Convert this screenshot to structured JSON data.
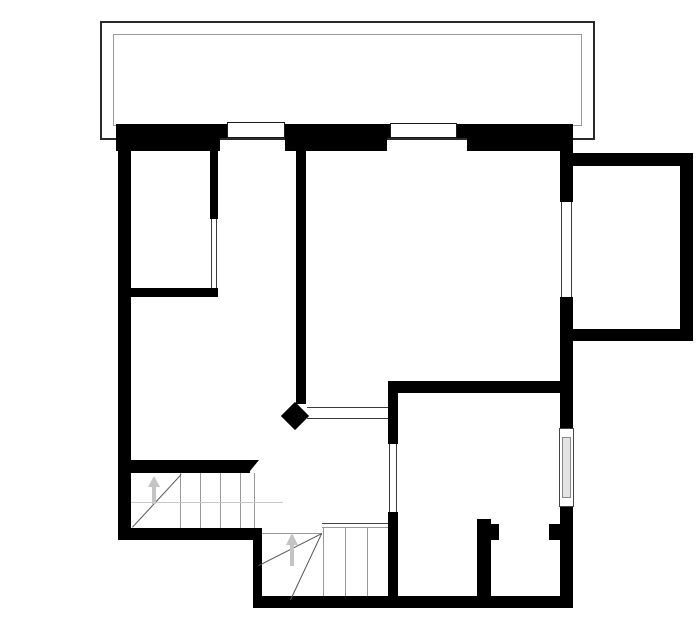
{
  "plan": {
    "canvas": {
      "w": 700,
      "h": 644,
      "bg": "#ffffff"
    },
    "palette": {
      "wall": "#000000",
      "terrace_outer_border": "#2a2a2a",
      "terrace_inner_border": "#9a9a9a",
      "window_border": "#1a1a1a",
      "door_line": "#3a3a3a",
      "stair_dark": "#444444",
      "stair_gray": "#999999",
      "stair_light": "#c8c8c8",
      "diag": "#555555",
      "arrow": "#c4c4c4",
      "glazing_fill": "#e3e3e3",
      "glazing_border": "#8a8a8a",
      "white": "#ffffff"
    },
    "terrace": {
      "outer": {
        "name": "terrace-outer-outline",
        "x": 100,
        "y": 21,
        "w": 495,
        "h": 119
      },
      "inner": {
        "name": "terrace-inner-outline",
        "x": 113,
        "y": 34,
        "w": 469,
        "h": 92
      }
    },
    "walls": [
      {
        "name": "top-wall-left-outer",
        "x": 116,
        "y": 124,
        "w": 111,
        "h": 14
      },
      {
        "name": "top-wall-left-inner",
        "x": 116,
        "y": 138,
        "w": 104,
        "h": 13
      },
      {
        "name": "top-wall-mid-outer",
        "x": 285,
        "y": 124,
        "w": 105,
        "h": 14
      },
      {
        "name": "top-wall-mid-inner",
        "x": 285,
        "y": 138,
        "w": 102,
        "h": 13
      },
      {
        "name": "top-wall-right-outer",
        "x": 457,
        "y": 124,
        "w": 116,
        "h": 14
      },
      {
        "name": "top-wall-right-inner",
        "x": 467,
        "y": 138,
        "w": 106,
        "h": 13
      },
      {
        "name": "left-exterior-wall",
        "x": 118,
        "y": 124,
        "w": 13,
        "h": 416
      },
      {
        "name": "right-exterior-wall-upper",
        "x": 560,
        "y": 124,
        "w": 13,
        "h": 78
      },
      {
        "name": "right-exterior-wall-middle",
        "x": 560,
        "y": 297,
        "w": 13,
        "h": 131
      },
      {
        "name": "right-exterior-wall-lower",
        "x": 560,
        "y": 507,
        "w": 13,
        "h": 101
      },
      {
        "name": "extension-top-wall",
        "x": 573,
        "y": 153,
        "w": 120,
        "h": 13
      },
      {
        "name": "extension-right-wall",
        "x": 680,
        "y": 153,
        "w": 13,
        "h": 188
      },
      {
        "name": "extension-bottom-wall",
        "x": 573,
        "y": 329,
        "w": 120,
        "h": 12
      },
      {
        "name": "bedroom-side-wall",
        "x": 210,
        "y": 138,
        "w": 8,
        "h": 81
      },
      {
        "name": "bedroom-bottom-wall",
        "x": 131,
        "y": 288,
        "w": 87,
        "h": 9
      },
      {
        "name": "center-hall-wall",
        "x": 296,
        "y": 138,
        "w": 10,
        "h": 266
      },
      {
        "name": "living-bottom-wall",
        "x": 388,
        "y": 381,
        "w": 172,
        "h": 12
      },
      {
        "name": "room-divider-wall-upper",
        "x": 388,
        "y": 381,
        "w": 10,
        "h": 63
      },
      {
        "name": "room-divider-wall-lower",
        "x": 388,
        "y": 512,
        "w": 10,
        "h": 89
      },
      {
        "name": "closet-wall-vertical",
        "x": 477,
        "y": 519,
        "w": 14,
        "h": 77
      },
      {
        "name": "closet-wall-stub",
        "x": 491,
        "y": 524,
        "w": 8,
        "h": 16
      },
      {
        "name": "closet-door-jamb",
        "x": 549,
        "y": 524,
        "w": 11,
        "h": 16
      },
      {
        "name": "stair-top-wall",
        "x": 128,
        "y": 460,
        "w": 122,
        "h": 13
      },
      {
        "name": "bottom-wall-left",
        "x": 118,
        "y": 528,
        "w": 137,
        "h": 12
      },
      {
        "name": "stair-divider-wall",
        "x": 253,
        "y": 528,
        "w": 9,
        "h": 80
      },
      {
        "name": "bottom-exterior-wall",
        "x": 253,
        "y": 596,
        "w": 320,
        "h": 12
      }
    ],
    "windows": [
      {
        "name": "window-top-1",
        "x": 227,
        "y": 122,
        "w": 58,
        "h": 16
      },
      {
        "name": "window-top-2",
        "x": 390,
        "y": 123,
        "w": 67,
        "h": 15
      }
    ],
    "glazed_window": {
      "name": "window-right",
      "x": 559,
      "y": 428,
      "w": 15,
      "h": 79,
      "inner": {
        "x": 562,
        "y": 437,
        "w": 9,
        "h": 61
      }
    },
    "openings": [
      {
        "name": "bedroom-door-opening",
        "o": "v",
        "a": 211,
        "b": 216,
        "start": 219,
        "len": 69
      },
      {
        "name": "balcony-door-opening",
        "o": "v",
        "a": 561,
        "b": 571,
        "start": 202,
        "len": 95
      },
      {
        "name": "room-door-opening",
        "o": "v",
        "a": 389,
        "b": 396,
        "start": 444,
        "len": 68
      },
      {
        "name": "hall-passage-opening",
        "o": "h",
        "a": 407,
        "b": 418,
        "start": 307,
        "len": 81
      }
    ],
    "caps": {
      "diamond": {
        "name": "wall-end-cap",
        "cx": 295,
        "cy": 416,
        "size": 20
      },
      "bevel": {
        "name": "stair-wall-bevel",
        "x": 250,
        "y": 460,
        "w": 9,
        "h": 11
      }
    },
    "stairs": {
      "lines": [
        {
          "name": "upper-stair-tread",
          "x": 180,
          "y": 473,
          "len": 55,
          "o": "v",
          "c": "stair_gray"
        },
        {
          "name": "upper-stair-tread",
          "x": 200,
          "y": 473,
          "len": 55,
          "o": "v",
          "c": "stair_gray"
        },
        {
          "name": "upper-stair-tread",
          "x": 220,
          "y": 473,
          "len": 55,
          "o": "v",
          "c": "stair_gray"
        },
        {
          "name": "upper-stair-tread",
          "x": 240,
          "y": 473,
          "len": 55,
          "o": "v",
          "c": "stair_gray"
        },
        {
          "name": "upper-stair-tread",
          "x": 254,
          "y": 473,
          "len": 55,
          "o": "v",
          "c": "stair_gray"
        },
        {
          "name": "upper-stair-landing-line",
          "x": 131,
          "y": 502,
          "len": 152,
          "o": "h",
          "c": "stair_light"
        },
        {
          "name": "lower-stair-edge-dark",
          "x": 322,
          "y": 523,
          "len": 66,
          "o": "h",
          "c": "stair_dark"
        },
        {
          "name": "lower-stair-edge-gray",
          "x": 322,
          "y": 527,
          "len": 66,
          "o": "h",
          "c": "stair_gray"
        },
        {
          "name": "lower-stair-left-edge",
          "x": 262,
          "y": 533,
          "len": 60,
          "o": "h",
          "c": "stair_gray"
        },
        {
          "name": "lower-stair-tread",
          "x": 323,
          "y": 527,
          "len": 69,
          "o": "v",
          "c": "stair_gray"
        },
        {
          "name": "lower-stair-tread",
          "x": 345,
          "y": 527,
          "len": 69,
          "o": "v",
          "c": "stair_gray"
        },
        {
          "name": "lower-stair-tread",
          "x": 367,
          "y": 527,
          "len": 69,
          "o": "v",
          "c": "stair_gray"
        }
      ],
      "diagonals": [
        {
          "name": "upper-stair-winder-line",
          "x1": 132,
          "y1": 527,
          "x2": 181,
          "y2": 474,
          "c": "diag"
        },
        {
          "name": "lower-stair-winder-line",
          "x1": 322,
          "y1": 534,
          "x2": 259,
          "y2": 566,
          "c": "diag"
        },
        {
          "name": "lower-stair-winder-line",
          "x1": 322,
          "y1": 534,
          "x2": 291,
          "y2": 600,
          "c": "diag"
        }
      ],
      "arrows": [
        {
          "name": "upper-stair-direction-arrow",
          "x": 154,
          "y": 476,
          "head": 11,
          "shaft": 17,
          "c": "arrow"
        },
        {
          "name": "lower-stair-direction-arrow",
          "x": 292,
          "y": 533,
          "head": 12,
          "shaft": 21,
          "c": "arrow"
        }
      ]
    }
  }
}
